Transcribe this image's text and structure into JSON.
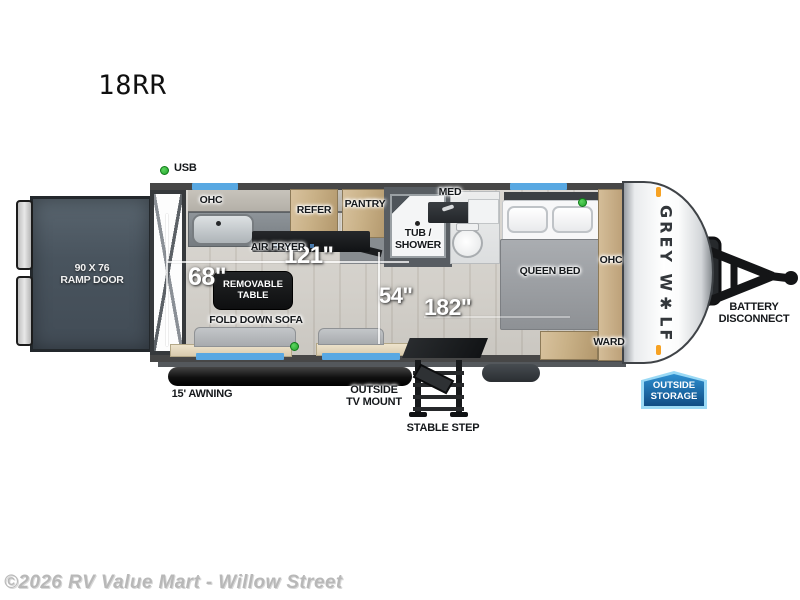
{
  "page": {
    "model_code": "18RR",
    "watermark": "©2026 RV Value Mart - Willow Street"
  },
  "brand": {
    "logo": "GREY W✱LF"
  },
  "exterior": {
    "ramp_door_label": "90 X 76\nRAMP DOOR",
    "awning_label": "15' AWNING",
    "tv_mount_label": "OUTSIDE\nTV MOUNT",
    "step_label": "STABLE STEP",
    "storage_badge_label": "OUTSIDE\nSTORAGE",
    "battery_label": "BATTERY\nDISCONNECT"
  },
  "interior": {
    "usb_label": "USB",
    "kitchen": {
      "ohc": "OHC",
      "air_fryer": "AIR FRYER",
      "refer": "REFER",
      "pantry": "PANTRY"
    },
    "bath": {
      "med": "MED",
      "tub_shower": "TUB /\nSHOWER"
    },
    "bedroom": {
      "queen_bed": "QUEEN BED",
      "ohc": "OHC",
      "ward": "WARD"
    },
    "living": {
      "removable_table": "REMOVABLE\nTABLE",
      "fold_down_sofa": "FOLD DOWN SOFA"
    }
  },
  "measurements": {
    "kitchen_run": "121\"",
    "rear_interior": "68\"",
    "mid_width": "54\"",
    "interior_length": "182\""
  },
  "colors": {
    "window_blue": "#58a8e2",
    "usb_green": "#2fb43c",
    "badge_blue": "#1c6fae",
    "ramp_slate": "#4e5a64",
    "clearance_orange": "#f7a223"
  }
}
